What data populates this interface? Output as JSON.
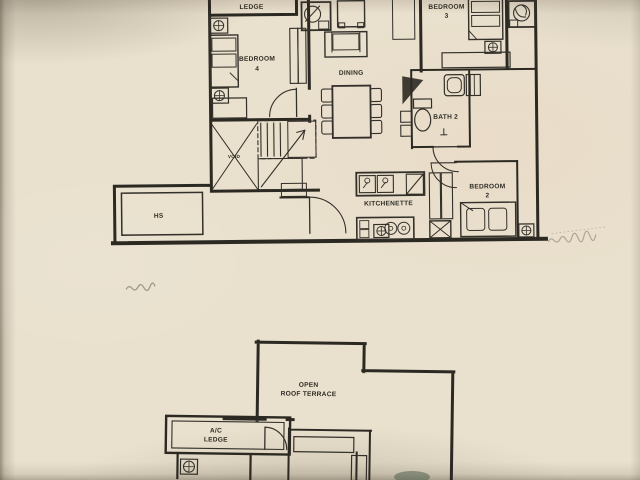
{
  "photo": {
    "paper_color": "#e9e0cd",
    "ink_color": "#2b2922",
    "content": "architectural floor plan, two levels (unit plan and open roof terrace plan)"
  },
  "upper_plan": {
    "labels": {
      "ledge": "LEDGE",
      "bedroom4_l1": "BEDROOM",
      "bedroom4_l2": "4",
      "bedroom3_l1": "BEDROOM",
      "bedroom3_l2": "3",
      "dining": "DINING",
      "bath2": "BATH 2",
      "kitchenette": "KITCHENETTE",
      "bedroom2_l1": "BEDROOM",
      "bedroom2_l2": "2",
      "hs": "HS",
      "void": "VOID"
    }
  },
  "lower_plan": {
    "labels": {
      "terrace_l1": "OPEN",
      "terrace_l2": "ROOF TERRACE",
      "ac_ledge_l1": "A/C",
      "ac_ledge_l2": "LEDGE"
    }
  }
}
